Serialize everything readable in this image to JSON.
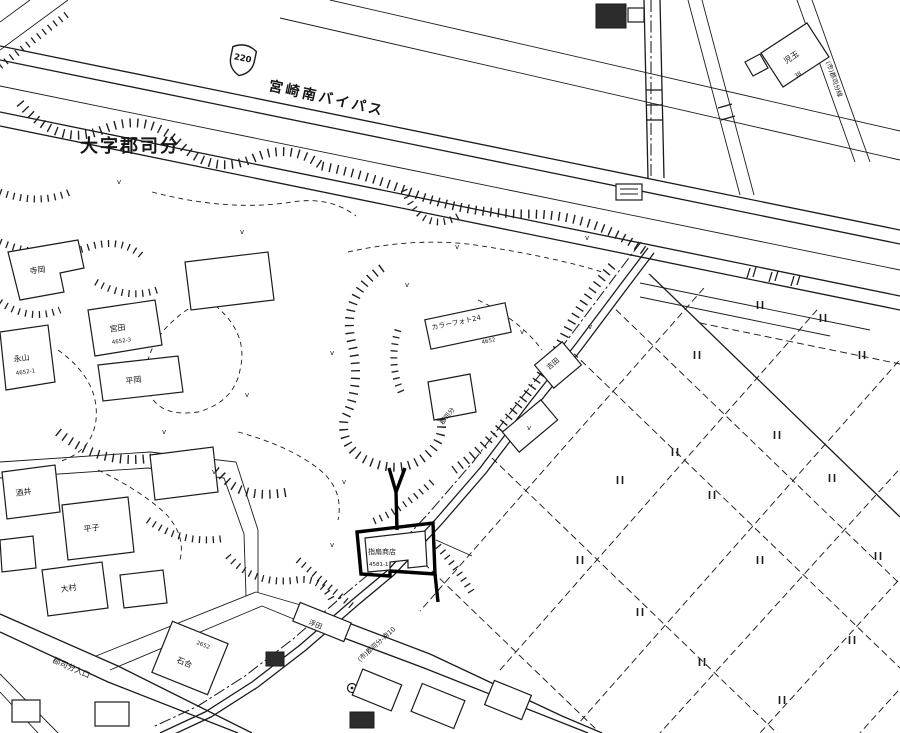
{
  "map": {
    "area_label": "大字郡司分",
    "highway": {
      "route_number": "220",
      "name": "宮崎南バイパス"
    },
    "road_labels": {
      "bottom": "(市)郡司分-南10",
      "mid": "郡司分",
      "top_right": "(市)郡司分線"
    },
    "bus_stop": "郡司分入口",
    "subject_property": {
      "name": "指扇商店",
      "address": "4581-1"
    },
    "buildings": {
      "teraoka": {
        "name": "寺岡"
      },
      "miyata": {
        "name": "宮田",
        "address": "4652-3"
      },
      "nagayama": {
        "name": "永山",
        "address": "4652-1"
      },
      "hiraoka": {
        "name": "平岡"
      },
      "kodama": {
        "name": "児玉",
        "address": "38"
      },
      "colorphoto": {
        "name": "カラーフォト24",
        "address": "4652"
      },
      "yoshida": {
        "name": "吉田"
      },
      "sakai": {
        "name": "酒井"
      },
      "hirako": {
        "name": "平子"
      },
      "omura": {
        "name": "大村"
      },
      "ukita": {
        "name": "浮田"
      },
      "ishiai": {
        "name": "石合",
        "address": "2652"
      }
    },
    "symbols": {
      "paddy": "||",
      "grass": "v"
    }
  }
}
